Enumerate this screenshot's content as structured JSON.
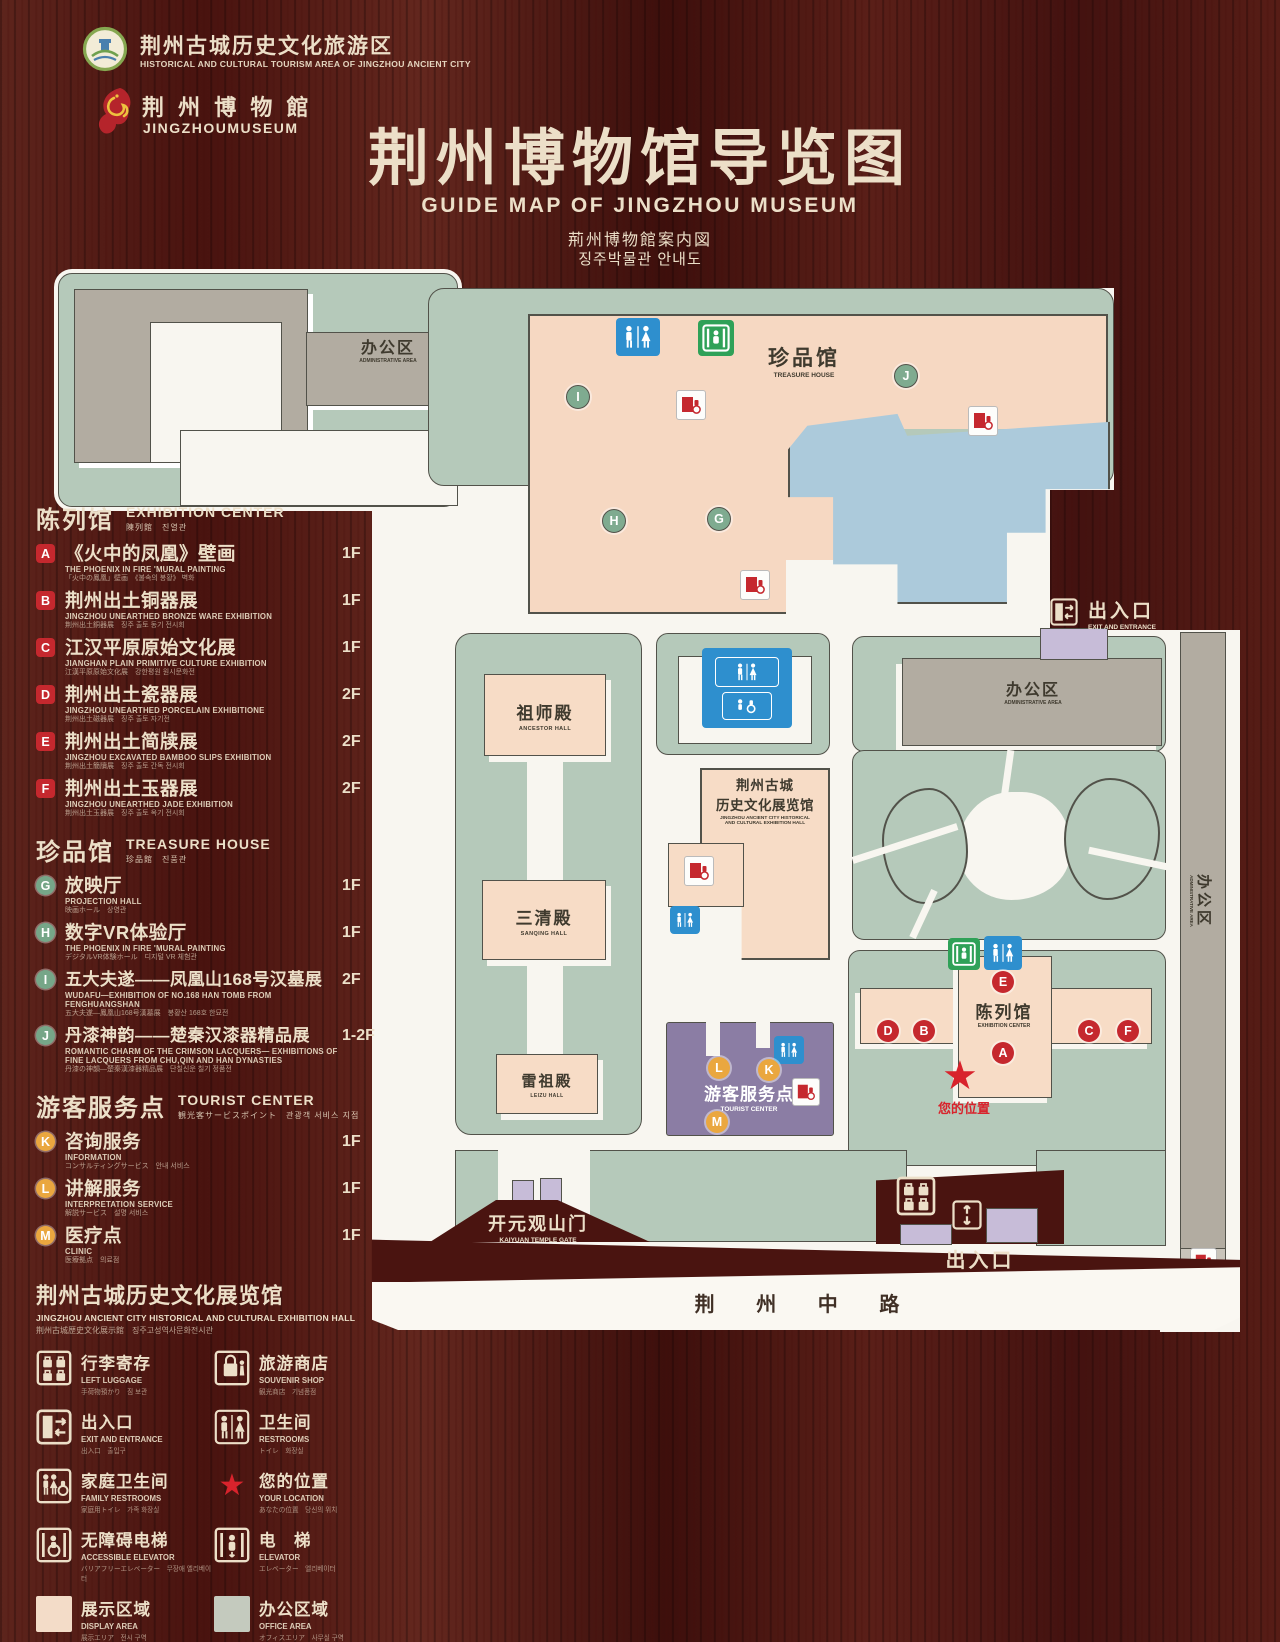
{
  "header": {
    "tourism_logo": {
      "title": "荆州古城历史文化旅游区",
      "subtitle": "HISTORICAL AND CULTURAL TOURISM AREA OF JINGZHOU ANCIENT CITY"
    },
    "museum_logo": {
      "title": "荆 州 博 物 館",
      "subtitle": "JINGZHOUMUSEUM"
    },
    "title": "荆州博物馆导览图",
    "subtitle_en": "GUIDE MAP OF JINGZHOU MUSEUM",
    "subtitle_ja": "荊州博物館案内図",
    "subtitle_ko": "징주박물관 안내도"
  },
  "legend": {
    "exhibition_center": {
      "zh": "陈列馆",
      "en": "EXHIBITION CENTER",
      "sub": "陳列館　진열관",
      "items": [
        {
          "id": "A",
          "zh": "《火中的凤凰》壁画",
          "en": "THE PHOENIX IN FIRE 'MURAL PAINTING",
          "sub": "「火中の鳳凰」壁画　《불속의 봉황》 벽화",
          "floor": "1F"
        },
        {
          "id": "B",
          "zh": "荆州出土铜器展",
          "en": "JINGZHOU UNEARTHED BRONZE WARE EXHIBITION",
          "sub": "荆州出土銅器展　징주 출토 동기 전시회",
          "floor": "1F"
        },
        {
          "id": "C",
          "zh": "江汉平原原始文化展",
          "en": "JIANGHAN PLAIN PRIMITIVE CULTURE EXHIBITION",
          "sub": "江漢平原原始文化展　강한평원 원시문화전",
          "floor": "1F"
        },
        {
          "id": "D",
          "zh": "荆州出土瓷器展",
          "en": "JINGZHOU UNEARTHED PORCELAIN EXHIBITIONE",
          "sub": "荆州出土磁器展　징주 출토 자기전",
          "floor": "2F"
        },
        {
          "id": "E",
          "zh": "荆州出土简牍展",
          "en": "JINGZHOU EXCAVATED BAMBOO SLIPS EXHIBITION",
          "sub": "荆州出土簡牘展　징주 출토 간독 전시회",
          "floor": "2F"
        },
        {
          "id": "F",
          "zh": "荆州出土玉器展",
          "en": "JINGZHOU UNEARTHED JADE EXHIBITION",
          "sub": "荆州出土玉器展　징주 출토 옥기 전시회",
          "floor": "2F"
        }
      ]
    },
    "treasure_house": {
      "zh": "珍品馆",
      "en": "TREASURE HOUSE",
      "sub": "珍品館　진품관",
      "items": [
        {
          "id": "G",
          "zh": "放映厅",
          "en": "PROJECTION HALL",
          "sub": "映画ホール　상영관",
          "floor": "1F"
        },
        {
          "id": "H",
          "zh": "数字VR体验厅",
          "en": "THE PHOENIX IN FIRE 'MURAL PAINTING",
          "sub": "デジタルVR体験ホール　디지털 VR 체험관",
          "floor": "1F"
        },
        {
          "id": "I",
          "zh": "五大夫遂——凤凰山168号汉墓展",
          "en": "WUDAFU—EXHIBITION OF NO.168 HAN TOMB FROM FENGHUANGSHAN",
          "sub": "五大夫遂—鳳凰山168号漢墓展　봉황산 168호 한묘전",
          "floor": "2F"
        },
        {
          "id": "J",
          "zh": "丹漆神韵——楚秦汉漆器精品展",
          "en": "ROMANTIC CHARM OF THE CRIMSON LACQUERS— EXHIBITIONS OF FINE LACQUERS FROM CHU,QIN AND HAN DYNASTIES",
          "sub": "丹漆の神韻—楚秦漢漆器精品展　단칠신운 칠기 정품전",
          "floor": "1-2F"
        }
      ]
    },
    "tourist_center": {
      "zh": "游客服务点",
      "en": "TOURIST CENTER",
      "sub": "観光客サービスポイント　관광객 서비스 지점",
      "items": [
        {
          "id": "K",
          "zh": "咨询服务",
          "en": "INFORMATION",
          "sub": "コンサルティングサービス　안내 서비스",
          "floor": "1F"
        },
        {
          "id": "L",
          "zh": "讲解服务",
          "en": "INTERPRETATION SERVICE",
          "sub": "解説サービス　설명 서비스",
          "floor": "1F"
        },
        {
          "id": "M",
          "zh": "医疗点",
          "en": "CLINIC",
          "sub": "医療拠点　의료점",
          "floor": "1F"
        }
      ]
    },
    "exhibition_hall_note": {
      "zh": "荆州古城历史文化展览馆",
      "en": "JINGZHOU ANCIENT CITY HISTORICAL AND CULTURAL EXHIBITION HALL",
      "sub": "荆州古城歴史文化展示館　징주고성역사문화전시관"
    },
    "symbols": [
      {
        "zh": "行李寄存",
        "en": "LEFT LUGGAGE",
        "sub": "手荷物預かり　짐 보관",
        "icon": "luggage-icon"
      },
      {
        "zh": "旅游商店",
        "en": "SOUVENIR SHOP",
        "sub": "観光商店　기념품점",
        "icon": "souvenir-shop-icon"
      },
      {
        "zh": "出入口",
        "en": "EXIT AND ENTRANCE",
        "sub": "出入口　출입구",
        "icon": "exit-entrance-icon"
      },
      {
        "zh": "卫生间",
        "en": "RESTROOMS",
        "sub": "トイレ　화장실",
        "icon": "restroom-icon"
      },
      {
        "zh": "家庭卫生间",
        "en": "FAMILY RESTROOMS",
        "sub": "家庭用トイレ　가족 화장실",
        "icon": "family-restroom-icon"
      },
      {
        "zh": "您的位置",
        "en": "YOUR LOCATION",
        "sub": "あなたの位置　당신의 위치",
        "icon": "your-location-star"
      },
      {
        "zh": "无障碍电梯",
        "en": "ACCESSIBLE ELEVATOR",
        "sub": "バリアフリーエレベーター　무장애 엘리베이터",
        "icon": "accessible-elevator-icon"
      },
      {
        "zh": "电　梯",
        "en": "ELEVATOR",
        "sub": "エレベーター　엘리베이터",
        "icon": "elevator-icon"
      },
      {
        "zh": "展示区域",
        "en": "DISPLAY AREA",
        "sub": "展示エリア　전시 구역",
        "icon": "display-area-swatch"
      },
      {
        "zh": "办公区域",
        "en": "OFFICE AREA",
        "sub": "オフィスエリア　사무실 구역",
        "icon": "office-area-swatch"
      }
    ]
  },
  "map": {
    "admin_area_topleft": {
      "zh": "办公区",
      "en": "ADMINISTRATIVE AREA"
    },
    "treasure_house": {
      "zh": "珍品馆",
      "en": "TREASURE HOUSE"
    },
    "exit_top": {
      "zh": "出入口",
      "en": "EXIT AND ENTRANCE"
    },
    "admin_area_right": {
      "zh": "办公区",
      "en": "ADMINISTRATIVE AREA"
    },
    "admin_area_strip": {
      "zh": "办公区",
      "en": "ADMINISTRATIVE AREA"
    },
    "ancestor_hall": {
      "zh": "祖师殿",
      "en": "ANCESTOR HALL"
    },
    "sanqing_hall": {
      "zh": "三清殿",
      "en": "SANQING HALL"
    },
    "leizu_hall": {
      "zh": "雷祖殿",
      "en": "LEIZU HALL"
    },
    "history_hall": {
      "zh1": "荆州古城",
      "zh2": "历史文化展览馆",
      "en1": "JINGZHOU ANCIENT CITY HISTORICAL",
      "en2": "AND CULTURAL EXHIBITION HALL"
    },
    "exhibition_center": {
      "zh": "陈列馆",
      "en": "EXHIBITION CENTER"
    },
    "tourist_center": {
      "zh": "游客服务点",
      "en": "TOURIST CENTER"
    },
    "your_location": {
      "zh": "您的位置"
    },
    "kaiyuan_gate": {
      "zh": "开元观山门",
      "en": "KAIYUAN TEMPLE GATE"
    },
    "exit_bottom": {
      "zh": "出入口",
      "en": "EXIT AND ENTRANCE"
    },
    "road": {
      "zh": "荆 州 中 路"
    },
    "markers": {
      "green": [
        {
          "letter": "I"
        },
        {
          "letter": "H"
        },
        {
          "letter": "G"
        },
        {
          "letter": "J"
        }
      ],
      "red": [
        {
          "letter": "E"
        },
        {
          "letter": "D"
        },
        {
          "letter": "B"
        },
        {
          "letter": "A"
        },
        {
          "letter": "C"
        },
        {
          "letter": "F"
        }
      ],
      "orange": [
        {
          "letter": "L"
        },
        {
          "letter": "K"
        },
        {
          "letter": "M"
        }
      ]
    }
  },
  "colors": {
    "wood": "#4a1410",
    "cream": "#ecdfc8",
    "map_white": "#f8f6f0",
    "green_area": "#b5c9ba",
    "gray_building": "#b2aca1",
    "pink_building": "#f7dcc6",
    "lake_blue": "#accadb",
    "purple_building": "#8b7da4",
    "light_purple": "#c7bcd8",
    "marker_red": "#c5282e",
    "marker_green": "#7fab90",
    "marker_orange": "#eaa73f",
    "restroom_blue": "#2e8fce",
    "elevator_green": "#2fa158",
    "location_red": "#d8232c"
  }
}
